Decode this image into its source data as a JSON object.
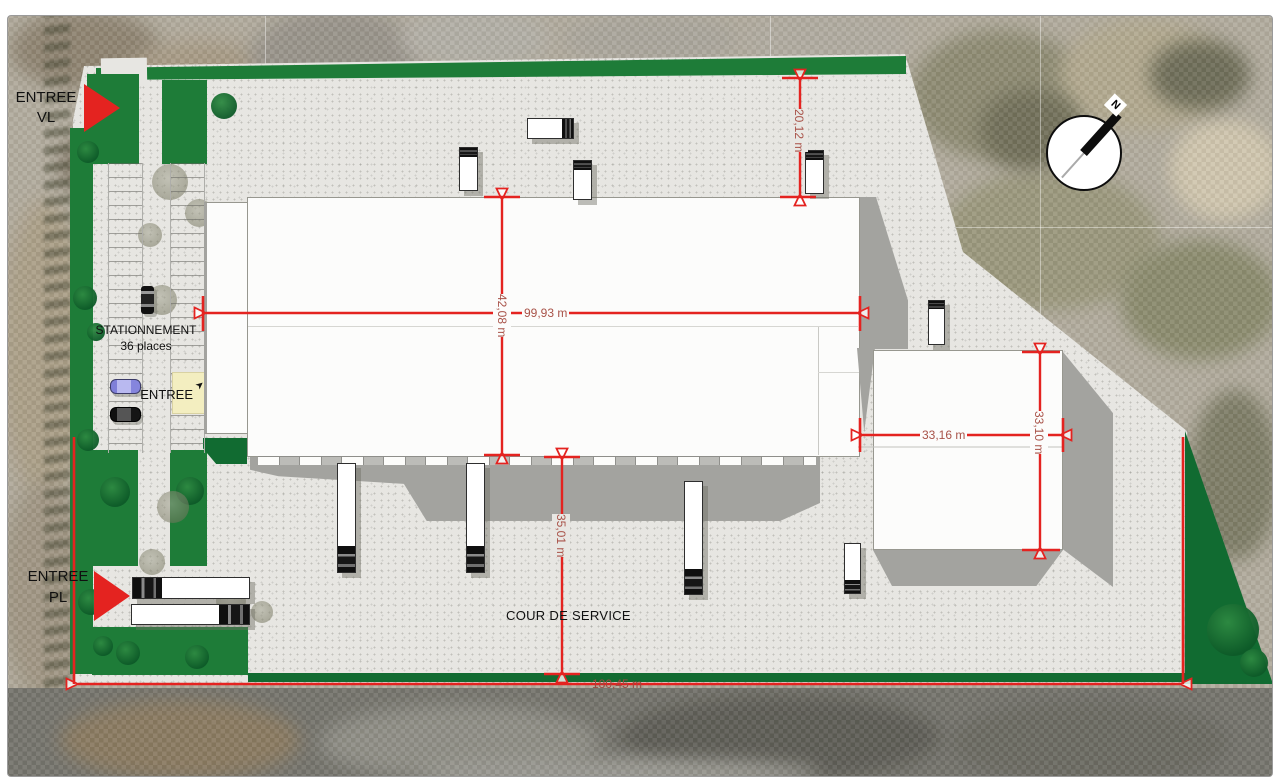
{
  "entrance_vl": {
    "line1": "ENTREE",
    "line2": "VL"
  },
  "entrance_pl": {
    "line1": "ENTREE",
    "line2": "PL"
  },
  "parking": {
    "line1": "STATIONNEMENT",
    "line2": "36 places",
    "entrance_label": "ENTREE"
  },
  "courtyard": {
    "label": "COUR DE SERVICE"
  },
  "compass": {
    "north": "N"
  },
  "dimensions": {
    "building_length": "99,93 m",
    "building_depth": "42,08 m",
    "north_setback": "20,12 m",
    "annex_width": "33,16 m",
    "annex_depth": "33,10 m",
    "service_yard_depth": "35,01 m",
    "site_frontage": "180,45 m"
  },
  "colors": {
    "dimension_red": "#e42320",
    "grass_green": "#1e7c38",
    "dark_green": "#116b31",
    "concrete_gray": "#e7e6e2",
    "building_white": "#fcfcfb"
  }
}
